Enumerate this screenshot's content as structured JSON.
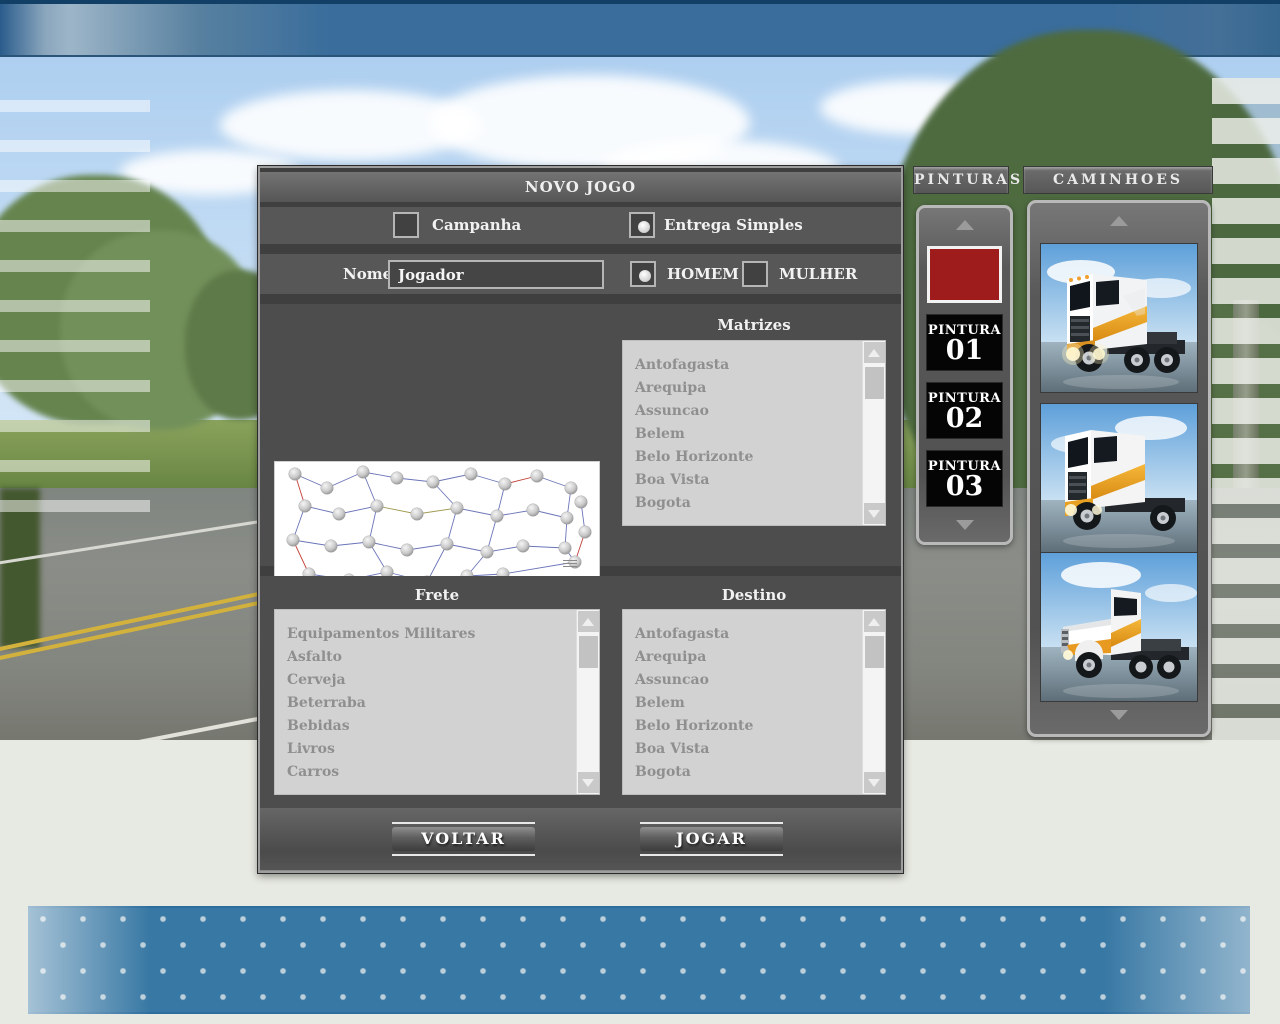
{
  "dialog": {
    "title": "NOVO JOGO",
    "mode": {
      "campanha": "Campanha",
      "entrega": "Entrega Simples"
    },
    "nome_label": "Nome",
    "nome_value": "Jogador",
    "gender": {
      "homem": "HOMEM",
      "mulher": "MULHER"
    },
    "matrizes_label": "Matrizes",
    "matrizes": [
      "Antofagasta",
      "Arequipa",
      "Assuncao",
      "Belem",
      "Belo Horizonte",
      "Boa Vista",
      "Bogota"
    ],
    "frete_label": "Frete",
    "fretes": [
      "Equipamentos Militares",
      "Asfalto",
      "Cerveja",
      "Beterraba",
      "Bebidas",
      "Livros",
      "Carros"
    ],
    "destino_label": "Destino",
    "destinos": [
      "Antofagasta",
      "Arequipa",
      "Assuncao",
      "Belem",
      "Belo Horizonte",
      "Boa Vista",
      "Bogota"
    ],
    "voltar": "VOLTAR",
    "jogar": "JOGAR",
    "map_legend": {
      "line1": "MINIMAPA V5.0",
      "line2": "MAPA EXPLORANDO",
      "line3": "A AMÉRICA V5.0",
      "url": "www.amazoncaminhoes.wordpress.com",
      "credit1": "Equipe de criação liderada por:",
      "credit2": "Roberto Bezerra"
    }
  },
  "pinturas": {
    "header": "PINTURAS",
    "selected_color": "#9e1c1c",
    "items": [
      {
        "label": "PINTURA",
        "num": "01"
      },
      {
        "label": "PINTURA",
        "num": "02"
      },
      {
        "label": "PINTURA",
        "num": "03"
      }
    ]
  },
  "caminhoes": {
    "header": "CAMINHOES"
  },
  "colors": {
    "band_blue": "#3878a4",
    "paint_red": "#9e1c1c",
    "panel_gray": "#585858"
  }
}
